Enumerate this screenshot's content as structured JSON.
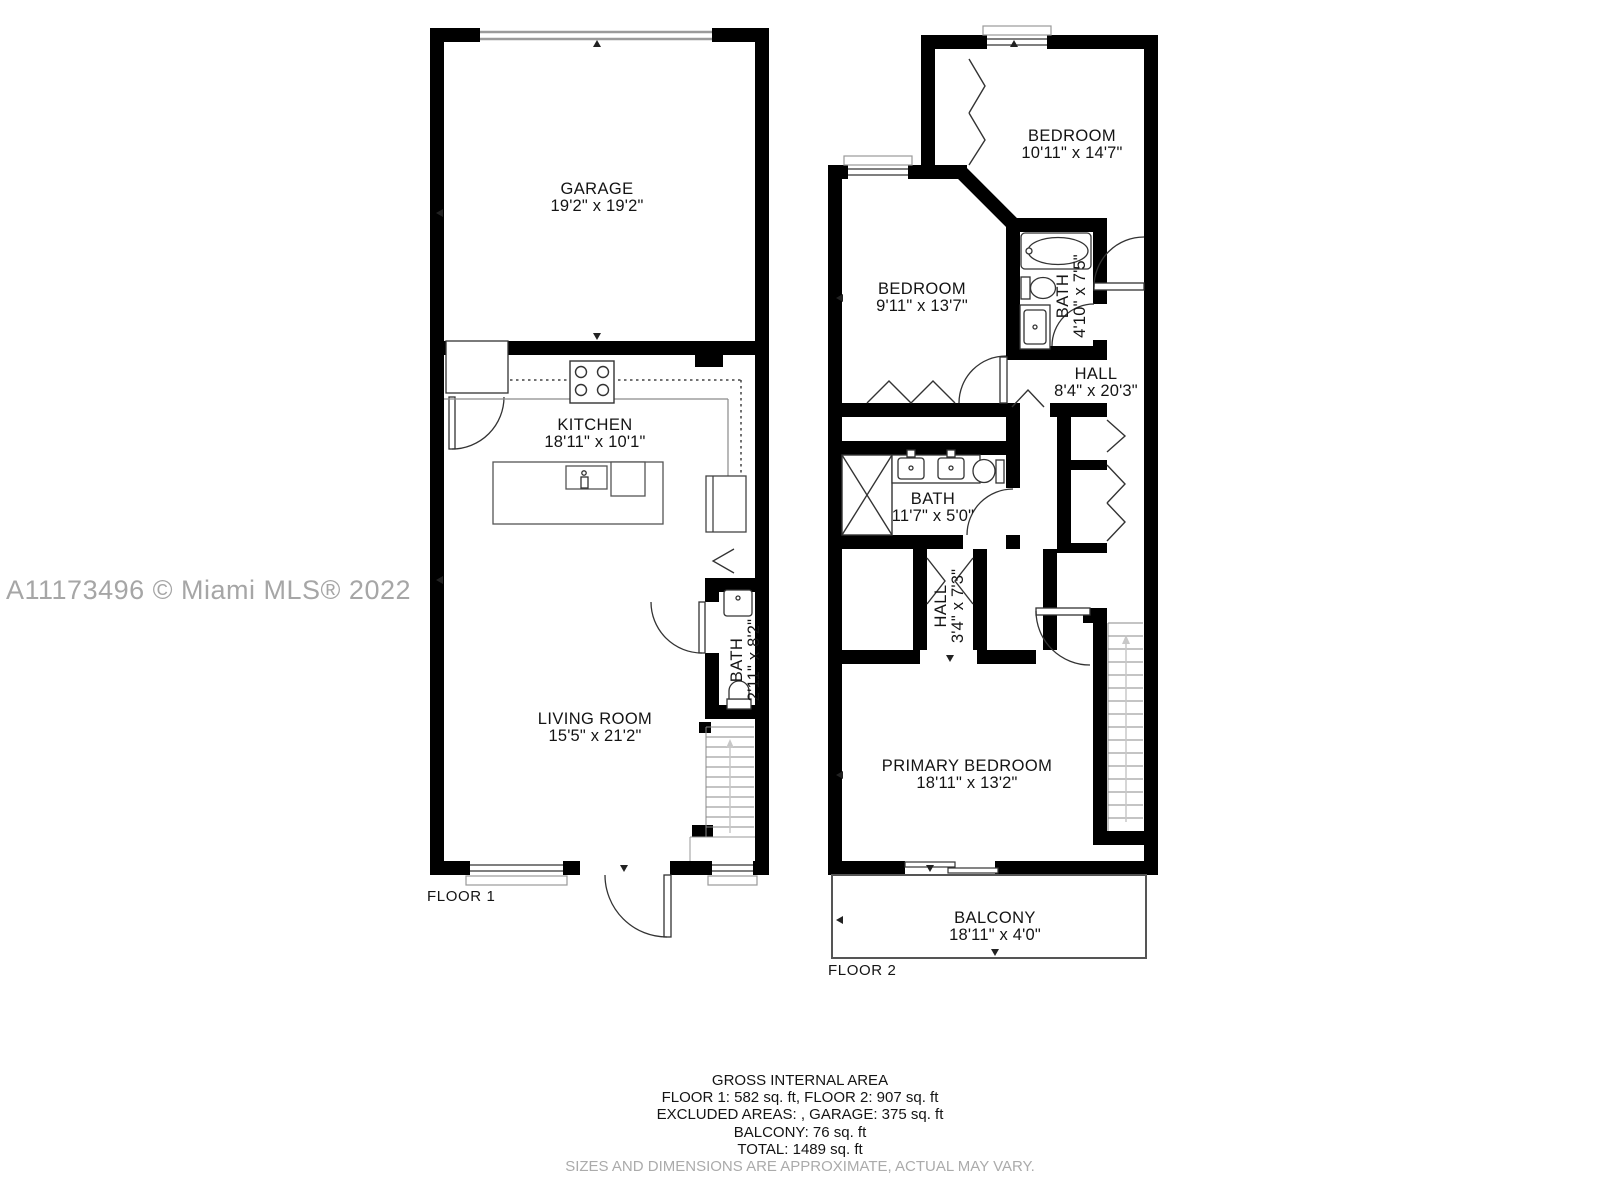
{
  "watermark": "A11173496 © Miami MLS® 2022",
  "colors": {
    "wall": "#000000",
    "fixture_line": "#333333",
    "thin_line": "#999999",
    "watermark_gray": "#a6a6a6",
    "disclaimer_gray": "#ababab"
  },
  "floor1": {
    "label": "FLOOR 1",
    "garage": {
      "name": "GARAGE",
      "dims": "19'2\" x 19'2\""
    },
    "kitchen": {
      "name": "KITCHEN",
      "dims": "18'11\" x 10'1\""
    },
    "bath": {
      "name": "BATH",
      "dims": "2'11\" x 8'2\""
    },
    "living_room": {
      "name": "LIVING ROOM",
      "dims": "15'5\" x 21'2\""
    }
  },
  "floor2": {
    "label": "FLOOR 2",
    "bedroom_top": {
      "name": "BEDROOM",
      "dims": "10'11\" x 14'7\""
    },
    "bedroom_mid": {
      "name": "BEDROOM",
      "dims": "9'11\" x 13'7\""
    },
    "bath_small": {
      "name": "BATH",
      "dims": "4'10\" x 7'5\""
    },
    "hall": {
      "name": "HALL",
      "dims": "8'4\" x 20'3\""
    },
    "bath_main": {
      "name": "BATH",
      "dims": "11'7\" x 5'0\""
    },
    "hall_small": {
      "name": "HALL",
      "dims": "3'4\" x 7'3\""
    },
    "primary_bedroom": {
      "name": "PRIMARY BEDROOM",
      "dims": "18'11\" x 13'2\""
    },
    "balcony": {
      "name": "BALCONY",
      "dims": "18'11\" x 4'0\""
    }
  },
  "summary": {
    "title": "GROSS INTERNAL AREA",
    "areas_line": "FLOOR 1: 582 sq. ft, FLOOR 2: 907 sq. ft",
    "excluded_line": "EXCLUDED AREAS: , GARAGE: 375 sq. ft",
    "balcony_line": "BALCONY: 76 sq. ft",
    "total_line": "TOTAL: 1489 sq. ft",
    "disclaimer": "SIZES AND DIMENSIONS ARE APPROXIMATE, ACTUAL MAY VARY."
  }
}
